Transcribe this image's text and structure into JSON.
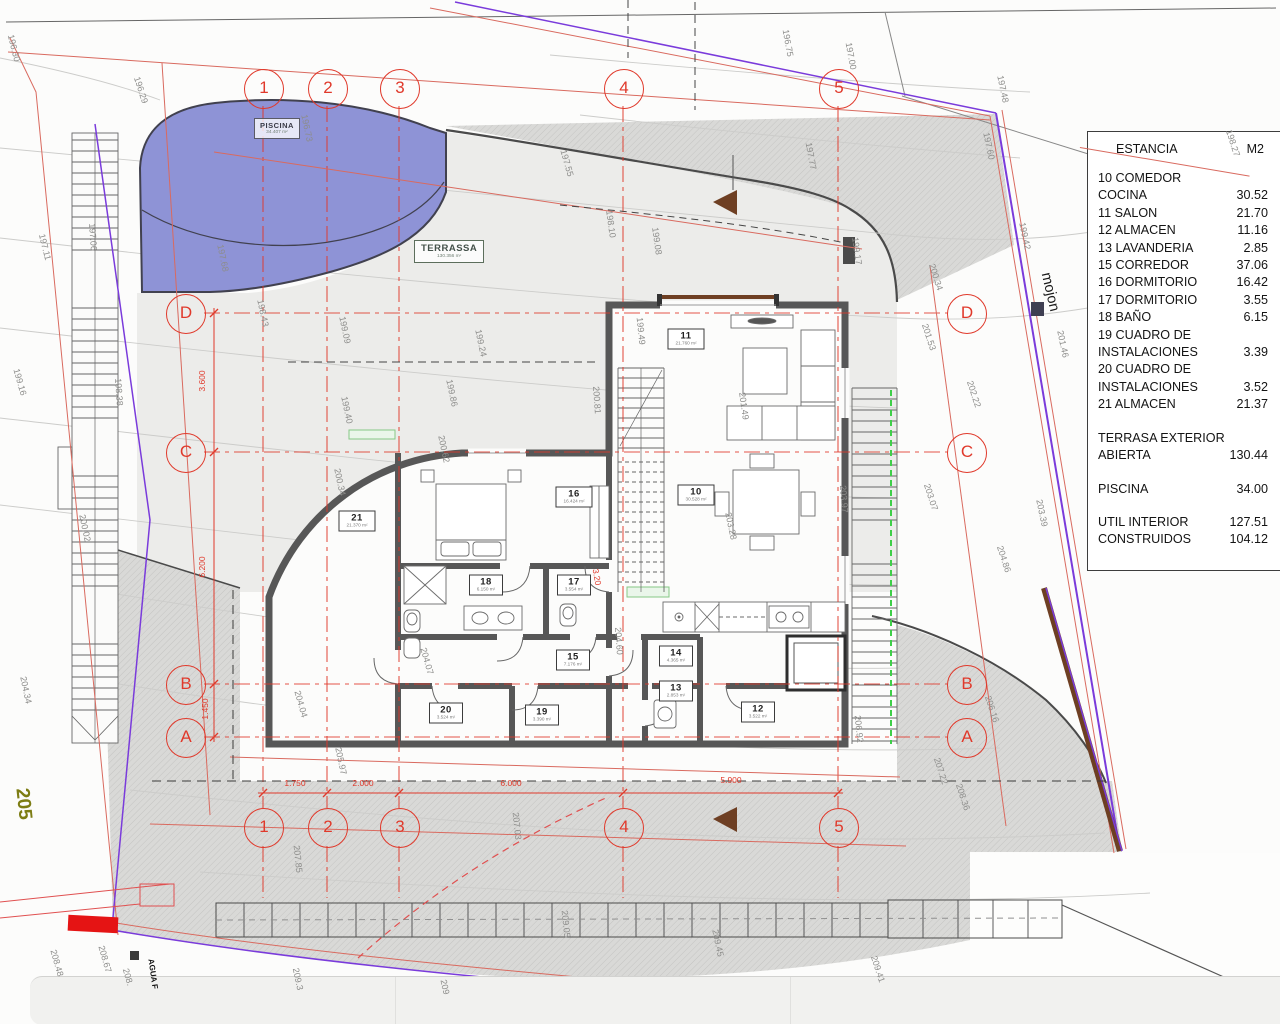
{
  "table": {
    "header": {
      "col1": "ESTANCIA",
      "col2": "M2"
    },
    "rows": [
      {
        "label": "10 COMEDOR COCINA",
        "value": "30.52",
        "gap": 0
      },
      {
        "label": "11 SALON",
        "value": "21.70",
        "gap": 0
      },
      {
        "label": "12 ALMACEN",
        "value": "11.16",
        "gap": 0
      },
      {
        "label": "13 LAVANDERIA",
        "value": "2.85",
        "gap": 0
      },
      {
        "label": "15 CORREDOR",
        "value": "37.06",
        "gap": 0
      },
      {
        "label": "16 DORMITORIO",
        "value": "16.42",
        "gap": 0
      },
      {
        "label": "17 DORMITORIO",
        "value": "3.55",
        "gap": 0
      },
      {
        "label": "18 BAÑO",
        "value": "6.15",
        "gap": 0
      },
      {
        "label": "19 CUADRO DE INSTALACIONES",
        "value": "3.39",
        "gap": 0
      },
      {
        "label": "20 CUADRO DE INSTALACIONES",
        "value": "3.52",
        "gap": 0
      },
      {
        "label": "21 ALMACEN",
        "value": "21.37",
        "gap": 0
      },
      {
        "label": "TERRASA EXTERIOR ABIERTA",
        "value": "130.44",
        "gap": 1
      },
      {
        "label": "PISCINA",
        "value": "34.00",
        "gap": 1
      },
      {
        "label": "UTIL INTERIOR",
        "value": "127.51",
        "gap": 1
      },
      {
        "label": "CONSTRUIDOS",
        "value": "104.12",
        "gap": 0
      }
    ]
  },
  "grid": {
    "cols": [
      {
        "label": "1",
        "x": 263
      },
      {
        "label": "2",
        "x": 327
      },
      {
        "label": "3",
        "x": 399
      },
      {
        "label": "4",
        "x": 623
      },
      {
        "label": "5",
        "x": 838
      }
    ],
    "rows": [
      {
        "label": "D",
        "y": 313
      },
      {
        "label": "C",
        "y": 452
      },
      {
        "label": "B",
        "y": 684
      },
      {
        "label": "A",
        "y": 737
      }
    ],
    "top_y": 88,
    "bottom_y": 827,
    "left_x": 185,
    "right_x": 966
  },
  "rooms": [
    {
      "num": "11",
      "area": "21.760 m²",
      "x": 686,
      "y": 339
    },
    {
      "num": "10",
      "area": "30.528 m²",
      "x": 696,
      "y": 495
    },
    {
      "num": "21",
      "area": "21.370 m²",
      "x": 357,
      "y": 521
    },
    {
      "num": "16",
      "area": "16.424 m²",
      "x": 574,
      "y": 497
    },
    {
      "num": "18",
      "area": "6.150 m²",
      "x": 486,
      "y": 585
    },
    {
      "num": "17",
      "area": "3.554 m²",
      "x": 574,
      "y": 585
    },
    {
      "num": "15",
      "area": "7.176 m²",
      "x": 573,
      "y": 660
    },
    {
      "num": "14",
      "area": "4.365 m²",
      "x": 676,
      "y": 656
    },
    {
      "num": "13",
      "area": "2.853 m²",
      "x": 676,
      "y": 691
    },
    {
      "num": "12",
      "area": "3.522 m²",
      "x": 758,
      "y": 712
    },
    {
      "num": "20",
      "area": "3.524 m²",
      "x": 446,
      "y": 713
    },
    {
      "num": "19",
      "area": "3.390 m²",
      "x": 542,
      "y": 715
    }
  ],
  "zones": {
    "piscina": {
      "title": "PISCINA",
      "area": "34.407 m²"
    },
    "terrassa": {
      "title": "TERRASSA",
      "area": "130.356 m²"
    }
  },
  "dimensions": {
    "bottom": [
      {
        "t": "1.750",
        "x": 295,
        "y": 783
      },
      {
        "t": "2.000",
        "x": 363,
        "y": 783
      },
      {
        "t": "6.000",
        "x": 511,
        "y": 783
      },
      {
        "t": "5.900",
        "x": 731,
        "y": 780
      }
    ],
    "left": [
      {
        "t": "3.600",
        "x": 202,
        "y": 381
      },
      {
        "t": "6.200",
        "x": 202,
        "y": 567
      },
      {
        "t": "1.450",
        "x": 205,
        "y": 709
      }
    ],
    "other": [
      {
        "t": "3.20",
        "x": 597,
        "y": 577,
        "r": 80
      }
    ]
  },
  "contours": [
    {
      "t": "196.30",
      "x": 14,
      "y": 48,
      "r": 76
    },
    {
      "t": "197.11",
      "x": 45,
      "y": 247,
      "r": 76
    },
    {
      "t": "199.16",
      "x": 20,
      "y": 382,
      "r": 74
    },
    {
      "t": "200.02",
      "x": 85,
      "y": 528,
      "r": 78
    },
    {
      "t": "204.34",
      "x": 26,
      "y": 690,
      "r": 78
    },
    {
      "t": "196.29",
      "x": 141,
      "y": 90,
      "r": 72
    },
    {
      "t": "197.06",
      "x": 93,
      "y": 237,
      "r": 86
    },
    {
      "t": "198.38",
      "x": 119,
      "y": 392,
      "r": 86
    },
    {
      "t": "197.68",
      "x": 223,
      "y": 258,
      "r": 78
    },
    {
      "t": "196.73",
      "x": 307,
      "y": 128,
      "r": 78
    },
    {
      "t": "198.43",
      "x": 263,
      "y": 313,
      "r": 78
    },
    {
      "t": "199.09",
      "x": 345,
      "y": 330,
      "r": 78
    },
    {
      "t": "200.34",
      "x": 340,
      "y": 482,
      "r": 78
    },
    {
      "t": "199.24",
      "x": 481,
      "y": 343,
      "r": 78
    },
    {
      "t": "199.40",
      "x": 347,
      "y": 410,
      "r": 78
    },
    {
      "t": "199.86",
      "x": 452,
      "y": 393,
      "r": 78
    },
    {
      "t": "200.62",
      "x": 444,
      "y": 449,
      "r": 78
    },
    {
      "t": "197.55",
      "x": 567,
      "y": 163,
      "r": 74
    },
    {
      "t": "198.10",
      "x": 611,
      "y": 224,
      "r": 82
    },
    {
      "t": "199.08",
      "x": 657,
      "y": 241,
      "r": 82
    },
    {
      "t": "199.49",
      "x": 641,
      "y": 331,
      "r": 84
    },
    {
      "t": "200.81",
      "x": 597,
      "y": 400,
      "r": 86
    },
    {
      "t": "201.49",
      "x": 744,
      "y": 406,
      "r": 82
    },
    {
      "t": "203.28",
      "x": 731,
      "y": 526,
      "r": 78
    },
    {
      "t": "204.60",
      "x": 619,
      "y": 641,
      "r": 86
    },
    {
      "t": "204.07",
      "x": 427,
      "y": 661,
      "r": 74
    },
    {
      "t": "204.04",
      "x": 301,
      "y": 704,
      "r": 74
    },
    {
      "t": "205.97",
      "x": 341,
      "y": 761,
      "r": 78
    },
    {
      "t": "207.85",
      "x": 298,
      "y": 859,
      "r": 84
    },
    {
      "t": "207.03",
      "x": 517,
      "y": 826,
      "r": 84
    },
    {
      "t": "206.92",
      "x": 859,
      "y": 729,
      "r": 84
    },
    {
      "t": "209.05",
      "x": 566,
      "y": 924,
      "r": 84
    },
    {
      "t": "209.45",
      "x": 718,
      "y": 943,
      "r": 78
    },
    {
      "t": "209.3",
      "x": 298,
      "y": 979,
      "r": 78
    },
    {
      "t": "209",
      "x": 445,
      "y": 987,
      "r": 78
    },
    {
      "t": "196.75",
      "x": 788,
      "y": 43,
      "r": 80
    },
    {
      "t": "197.00",
      "x": 851,
      "y": 56,
      "r": 80
    },
    {
      "t": "197.77",
      "x": 811,
      "y": 156,
      "r": 80
    },
    {
      "t": "197.48",
      "x": 1003,
      "y": 89,
      "r": 78
    },
    {
      "t": "197.60",
      "x": 989,
      "y": 146,
      "r": 78
    },
    {
      "t": "199.17",
      "x": 857,
      "y": 251,
      "r": 82
    },
    {
      "t": "200.34",
      "x": 936,
      "y": 277,
      "r": 72
    },
    {
      "t": "201.53",
      "x": 929,
      "y": 337,
      "r": 72
    },
    {
      "t": "202.22",
      "x": 974,
      "y": 394,
      "r": 72
    },
    {
      "t": "203.07",
      "x": 931,
      "y": 497,
      "r": 72
    },
    {
      "t": "203.97",
      "x": 844,
      "y": 499,
      "r": 86
    },
    {
      "t": "204.86",
      "x": 1004,
      "y": 559,
      "r": 72
    },
    {
      "t": "203.39",
      "x": 1042,
      "y": 513,
      "r": 78
    },
    {
      "t": "206.16",
      "x": 992,
      "y": 709,
      "r": 72
    },
    {
      "t": "207.22",
      "x": 941,
      "y": 771,
      "r": 72
    },
    {
      "t": "208.36",
      "x": 963,
      "y": 797,
      "r": 72
    },
    {
      "t": "209.41",
      "x": 878,
      "y": 969,
      "r": 72
    },
    {
      "t": "208.48",
      "x": 57,
      "y": 963,
      "r": 74
    },
    {
      "t": "208.67",
      "x": 105,
      "y": 959,
      "r": 74
    },
    {
      "t": "208.",
      "x": 128,
      "y": 977,
      "r": 74
    },
    {
      "t": "198.27",
      "x": 1233,
      "y": 143,
      "r": 72
    },
    {
      "t": "199.42",
      "x": 1025,
      "y": 236,
      "r": 78
    },
    {
      "t": "201.46",
      "x": 1063,
      "y": 344,
      "r": 78
    }
  ],
  "annotations": {
    "mojon": "mojon",
    "plot_number": "205",
    "agua": "AGUA F"
  },
  "colors": {
    "grid_red": "#e0392b",
    "boundary_red": "#d96a5f",
    "boundary_purple": "#7a3bdb",
    "pool_fill": "#8e93d6",
    "wall_gray": "#575757",
    "mojon_brown": "#6e3f23",
    "stair_green_dash": "#3ecf48",
    "terrace_fill": "#ececea",
    "hatch_fill": "#d9d9d7",
    "plot_olive": "#7d7d14"
  }
}
